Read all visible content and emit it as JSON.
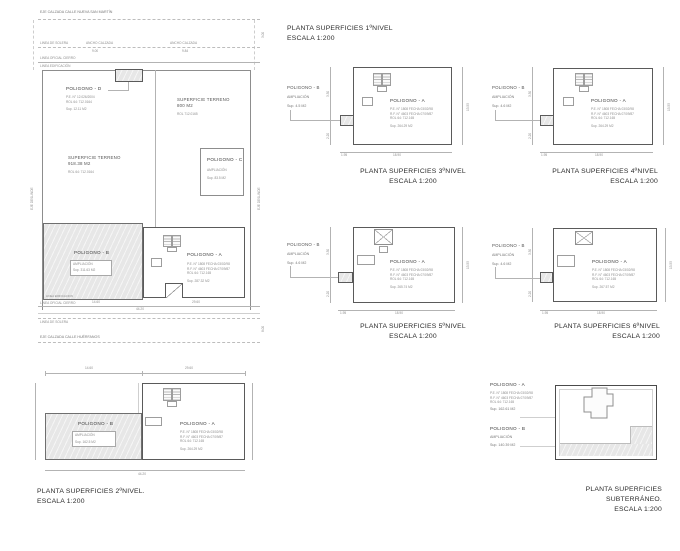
{
  "site": {
    "street_top": "EJE CALZADA CALLE NUEVA SAN MARTÍN",
    "linea_solera": "LINEA DE SOLERA",
    "ancho_1": "ANCHO CALZADA",
    "ancho_2": "ANCHO CALZADA",
    "dim_top_1": "9.00",
    "dim_top_2": "9.84",
    "linea_oficial": "LINEA OFICIAL CIERRO",
    "linea_edificacion": "LINEA EDIFICACIÓN",
    "eje_deslinde_left": "EJE DESLINDE",
    "eje_deslinde_right": "EJE DESLINDE",
    "dim_r1": "3.00",
    "dim_r2": "8.00",
    "pol_d": {
      "name": "POLIGONO - D",
      "l1": "P.E. N° 12.026/2004",
      "l2": "ROL 64: 712.0164",
      "sup": "Sup. 12.11 M2"
    },
    "terreno_800": {
      "t": "SUPERFICIE TERRENO",
      "m2": "800 M2",
      "rol": "ROL 712.0165"
    },
    "terreno_918": {
      "t": "SUPERFICIE TERRENO",
      "m2": "918.38 M2",
      "rol": "ROL 64: 712.0164"
    },
    "pol_c": {
      "name": "POLIGONO - C",
      "amp": "AMPLIACIÓN",
      "sup": "Sup. 83.5 M2"
    },
    "pol_b": {
      "name": "POLIGONO - B",
      "amp": "AMPLIACIÓN",
      "sup": "Sup. 311.63 M2"
    },
    "pol_a": {
      "name": "POLIGONO - A",
      "sup": "Sup. 287.32 M2"
    },
    "linea_edif_b": "LINEA EDIFICACION",
    "linea_oficial_b": "LINEA OFICIAL CIERRO",
    "linea_solera_b": "LINEA DE SOLERA",
    "street_bottom": "EJE CALZADA CALLE HUÉRFANOS",
    "dim_b1": "14.60",
    "dim_b2": "29.60",
    "dim_b_total": "44.20"
  },
  "common_a": {
    "name": "POLIGONO - A",
    "l1": "P.E. N° 1808 FECHA 03/02/98",
    "l2": "R.F. N° 4603 FECHA 07/09/87",
    "l3": "ROL 64: 712.165"
  },
  "common_b": {
    "name": "POLIGONO - B",
    "amp": "AMPLIACIÓN"
  },
  "small_dims": {
    "left1": "3.30",
    "left2": "2.20",
    "right": "13.55",
    "b1": "1.95",
    "b2": "18.90"
  },
  "levels": {
    "n1": {
      "b_sup": "Sup. 4.5 M2",
      "a_sup": "Sup. 264.29 M2"
    },
    "n4": {
      "b_sup": "Sup. 4.6 M2",
      "a_sup": "Sup. 264.29 M2"
    },
    "n5": {
      "b_sup": "Sup. 4.6 M2",
      "a_sup": "Sup. 265.74 M2"
    },
    "n6": {
      "b_sup": "Sup. 4.6 M2",
      "a_sup": "Sup. 267.57 M2"
    }
  },
  "plan2": {
    "b_sup": "Sup. 162.5 M2",
    "a_sup": "Sup. 264.29 M2",
    "dim1": "14.60",
    "dim2": "29.60",
    "total": "44.20"
  },
  "plan_sub": {
    "a_sup": "Sup. 162.61 M2",
    "b_sup": "Sup. 140.39 M2"
  },
  "titles": {
    "n1": {
      "t": "PLANTA SUPERFICIES 1ºNIVEL",
      "e": "ESCALA 1:200"
    },
    "n3": {
      "t": "PLANTA SUPERFICIES 3ºNIVEL",
      "e": "ESCALA 1:200"
    },
    "n4": {
      "t": "PLANTA SUPERFICIES 4ºNIVEL",
      "e": "ESCALA 1:200"
    },
    "n5": {
      "t": "PLANTA SUPERFICIES 5ºNIVEL",
      "e": "ESCALA 1:200"
    },
    "n6": {
      "t": "PLANTA SUPERFICIES 6ºNIVEL",
      "e": "ESCALA 1:200"
    },
    "n2": {
      "t": "PLANTA SUPERFICIES 2ºNIVEL.",
      "e": "ESCALA 1:200"
    },
    "sub": {
      "t": "PLANTA SUPERFICIES",
      "t2": "SUBTERRÁNEO.",
      "e": "ESCALA 1:200"
    }
  }
}
